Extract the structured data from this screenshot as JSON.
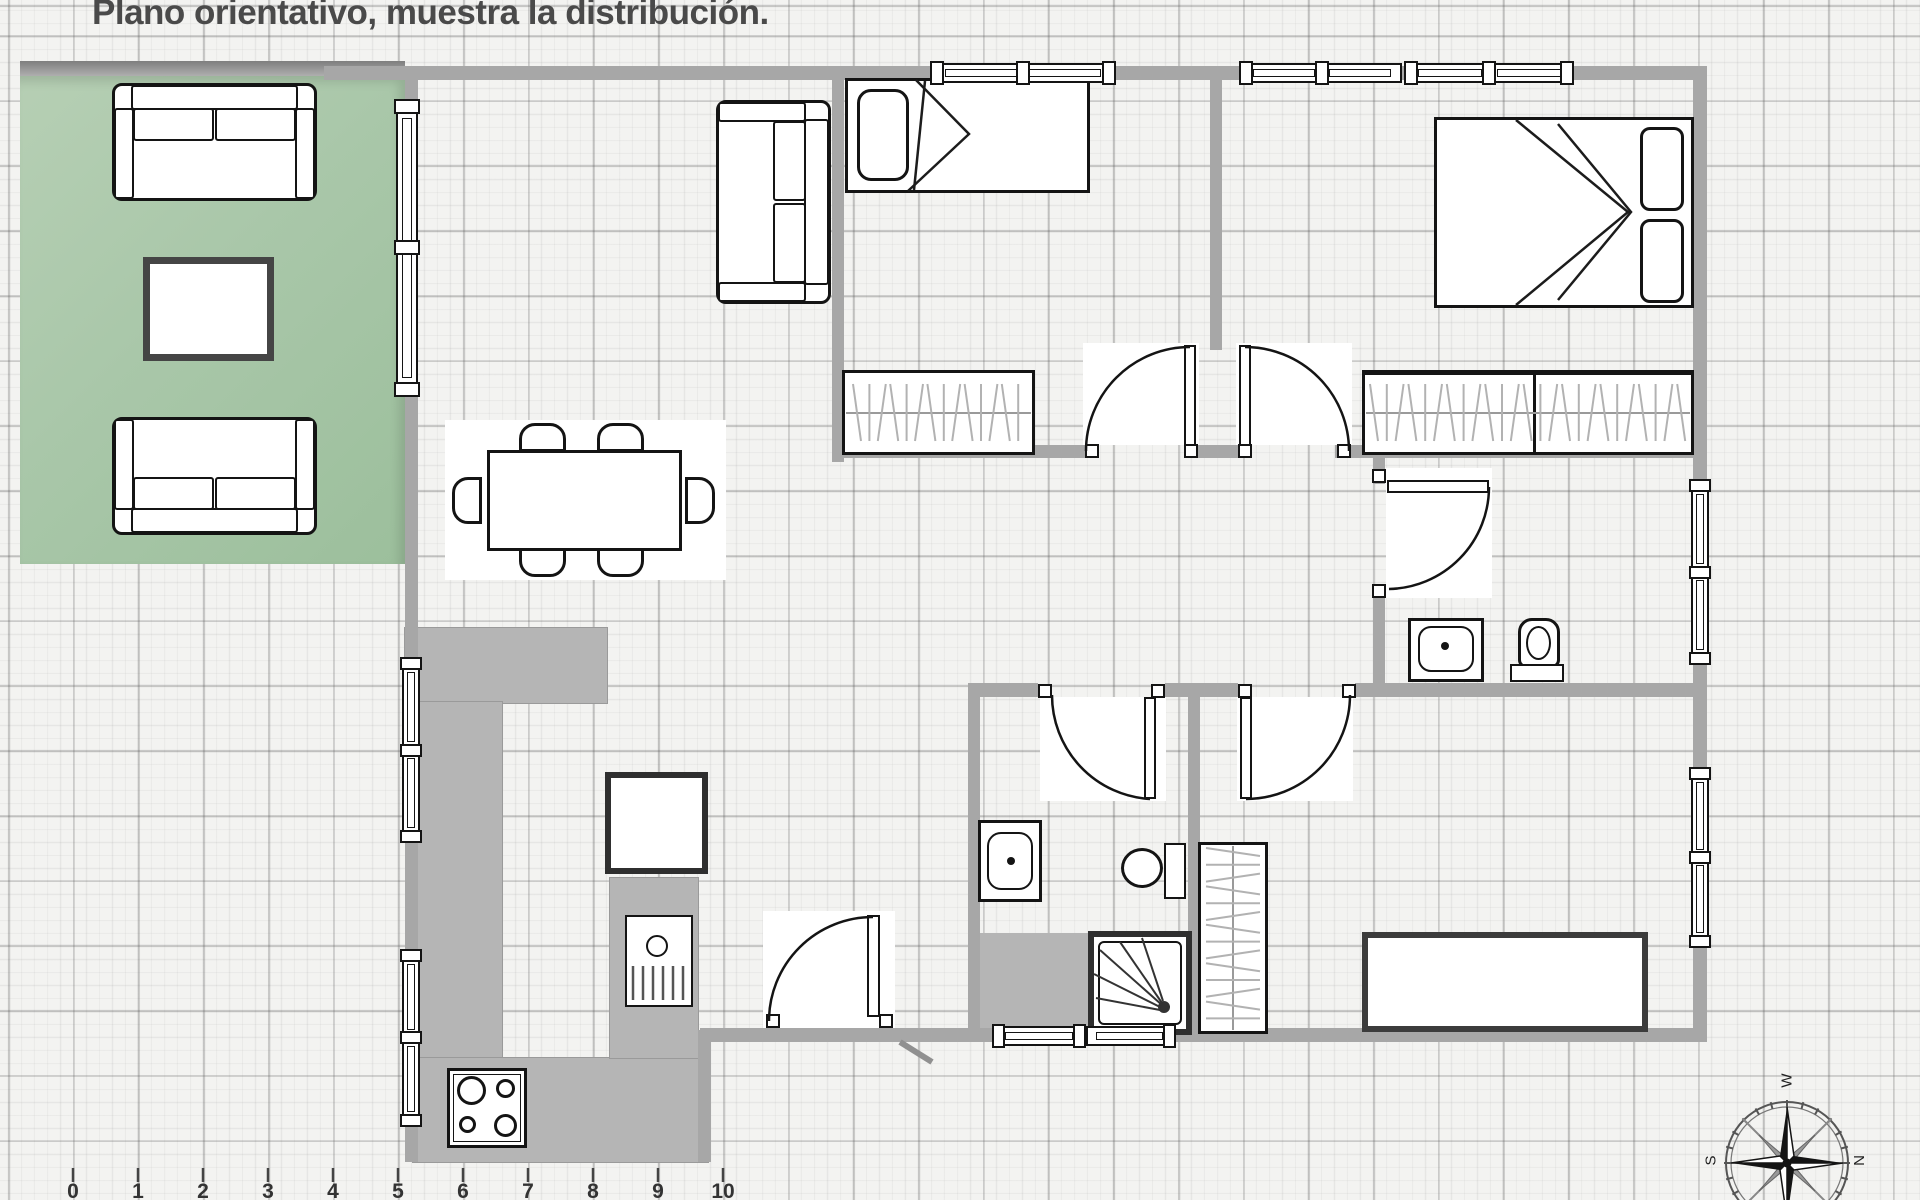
{
  "title": "Plano orientativo, muestra la distribución.",
  "scale": {
    "unit_meters": 1,
    "labels": [
      "0",
      "1",
      "2",
      "3",
      "4",
      "5",
      "6",
      "7",
      "8",
      "9",
      "10"
    ]
  },
  "compass": {
    "west": "W",
    "south": "S",
    "north": "N"
  },
  "colors": {
    "wall": "#a7a7a7",
    "terrace_green": "#a9c7a9",
    "counter_gray": "#b5b5b5",
    "paper": "#f3f3f1",
    "line": "#141414"
  }
}
